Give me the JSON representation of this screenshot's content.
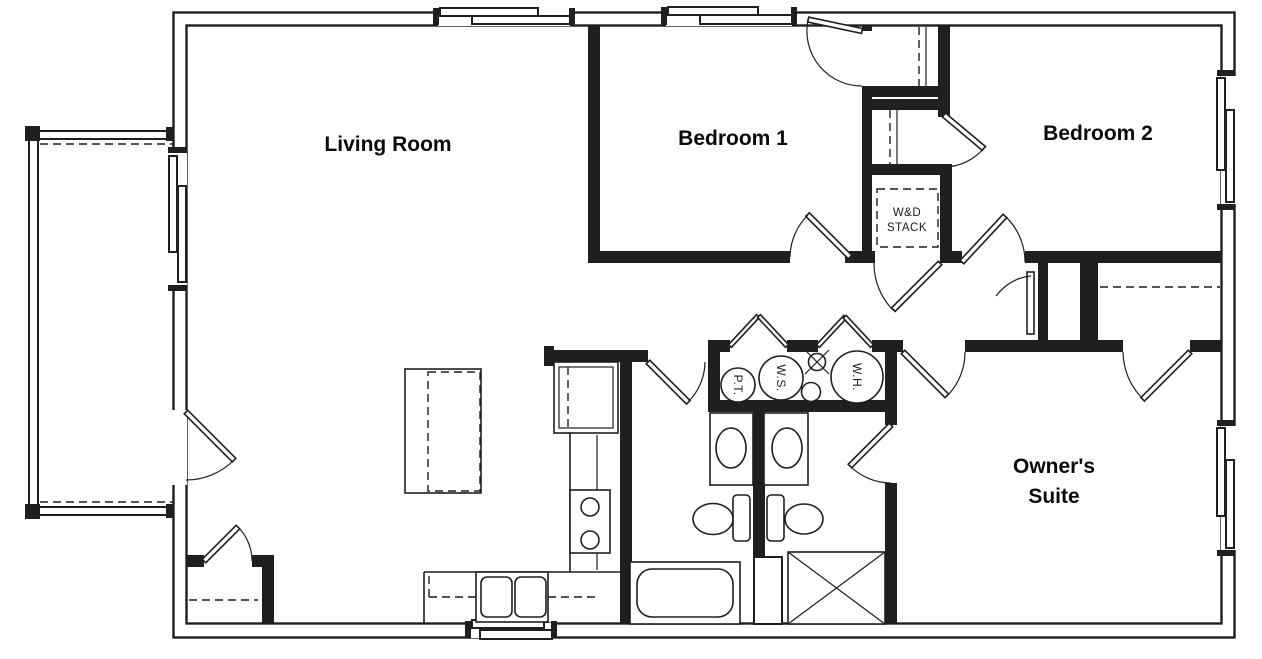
{
  "floor_plan": {
    "rooms": {
      "living_room": "Living Room",
      "bedroom_1": "Bedroom 1",
      "bedroom_2": "Bedroom 2",
      "owners_suite_line1": "Owner's",
      "owners_suite_line2": "Suite"
    },
    "utility_labels": {
      "washer_dryer_line1": "W&D",
      "washer_dryer_line2": "STACK",
      "pressure_tank": "P.T.",
      "water_softener": "W.S.",
      "water_heater": "W.H."
    },
    "colors": {
      "line": "#1f1f1f",
      "background": "#ffffff"
    }
  }
}
